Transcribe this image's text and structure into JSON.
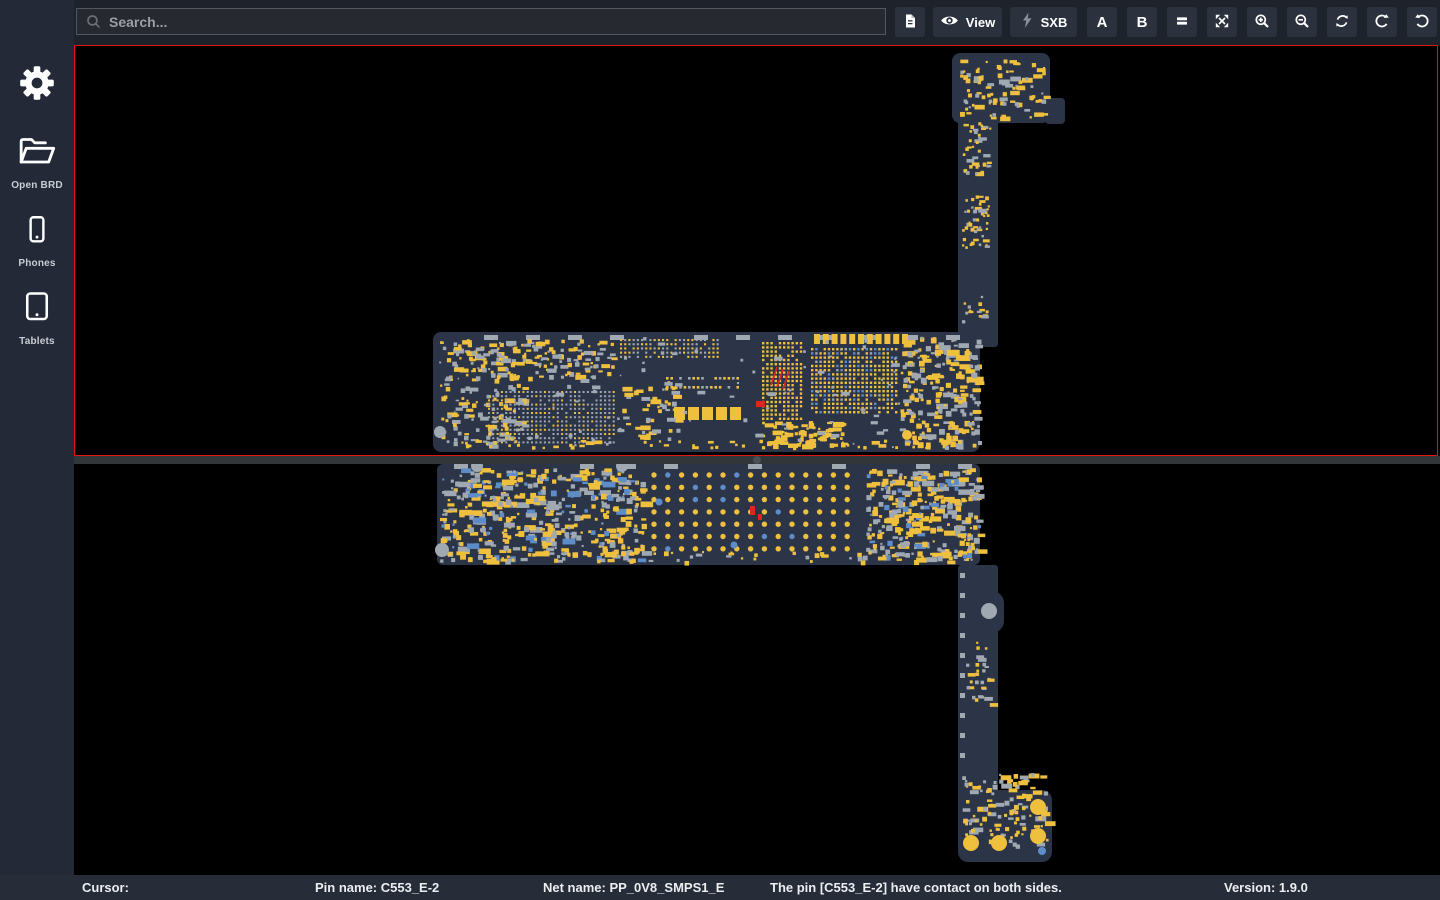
{
  "sidebar": {
    "items": [
      {
        "id": "open-brd",
        "label": "Open BRD"
      },
      {
        "id": "phones",
        "label": "Phones"
      },
      {
        "id": "tablets",
        "label": "Tablets"
      }
    ]
  },
  "toolbar": {
    "search_placeholder": "Search...",
    "view_label": "View",
    "sxb_label": "SXB",
    "side_a_label": "A",
    "side_b_label": "B"
  },
  "board_views": [
    {
      "id": "top-view",
      "selected": true
    },
    {
      "id": "bottom-view",
      "selected": false
    }
  ],
  "statusbar": {
    "cursor_label": "Cursor:",
    "pin_name": "Pin name: C553_E-2",
    "net_name": "Net name: PP_0V8_SMPS1_E",
    "message": "The pin [C553_E-2] have contact on both sides.",
    "version": "Version: 1.9.0"
  },
  "colors": {
    "selection_red": "#e01510",
    "board": "#2b3547",
    "pad_yellow": "#efbf3e",
    "pad_gray": "#a0a8b2",
    "pad_blue": "#5e8cc8",
    "pad_red": "#e02420",
    "canvas_bg": "#000000"
  }
}
